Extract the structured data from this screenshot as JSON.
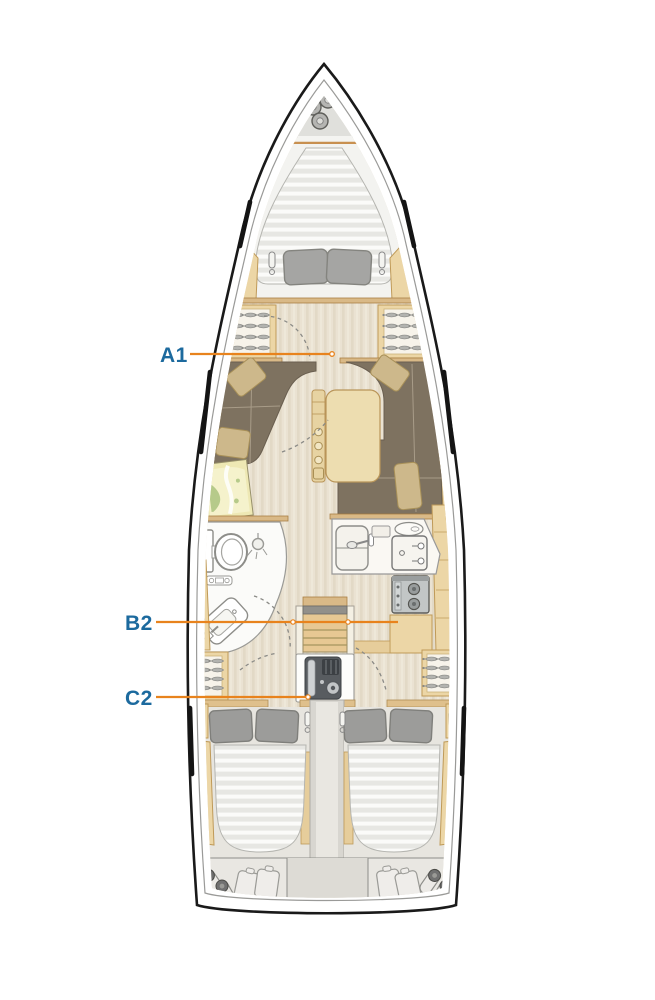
{
  "diagram": {
    "type": "yacht-interior-deck-plan",
    "labels": [
      {
        "id": "a1",
        "text": "A1"
      },
      {
        "id": "b2",
        "text": "B2"
      },
      {
        "id": "c2",
        "text": "C2"
      }
    ],
    "colors": {
      "label_text": "#1c6a9e",
      "leader_line": "#e8831d",
      "hull_outline": "#1a1a1a",
      "wood_trim": "#ecd6a6",
      "upholstery": "#7e7260",
      "background": "#ffffff"
    }
  }
}
